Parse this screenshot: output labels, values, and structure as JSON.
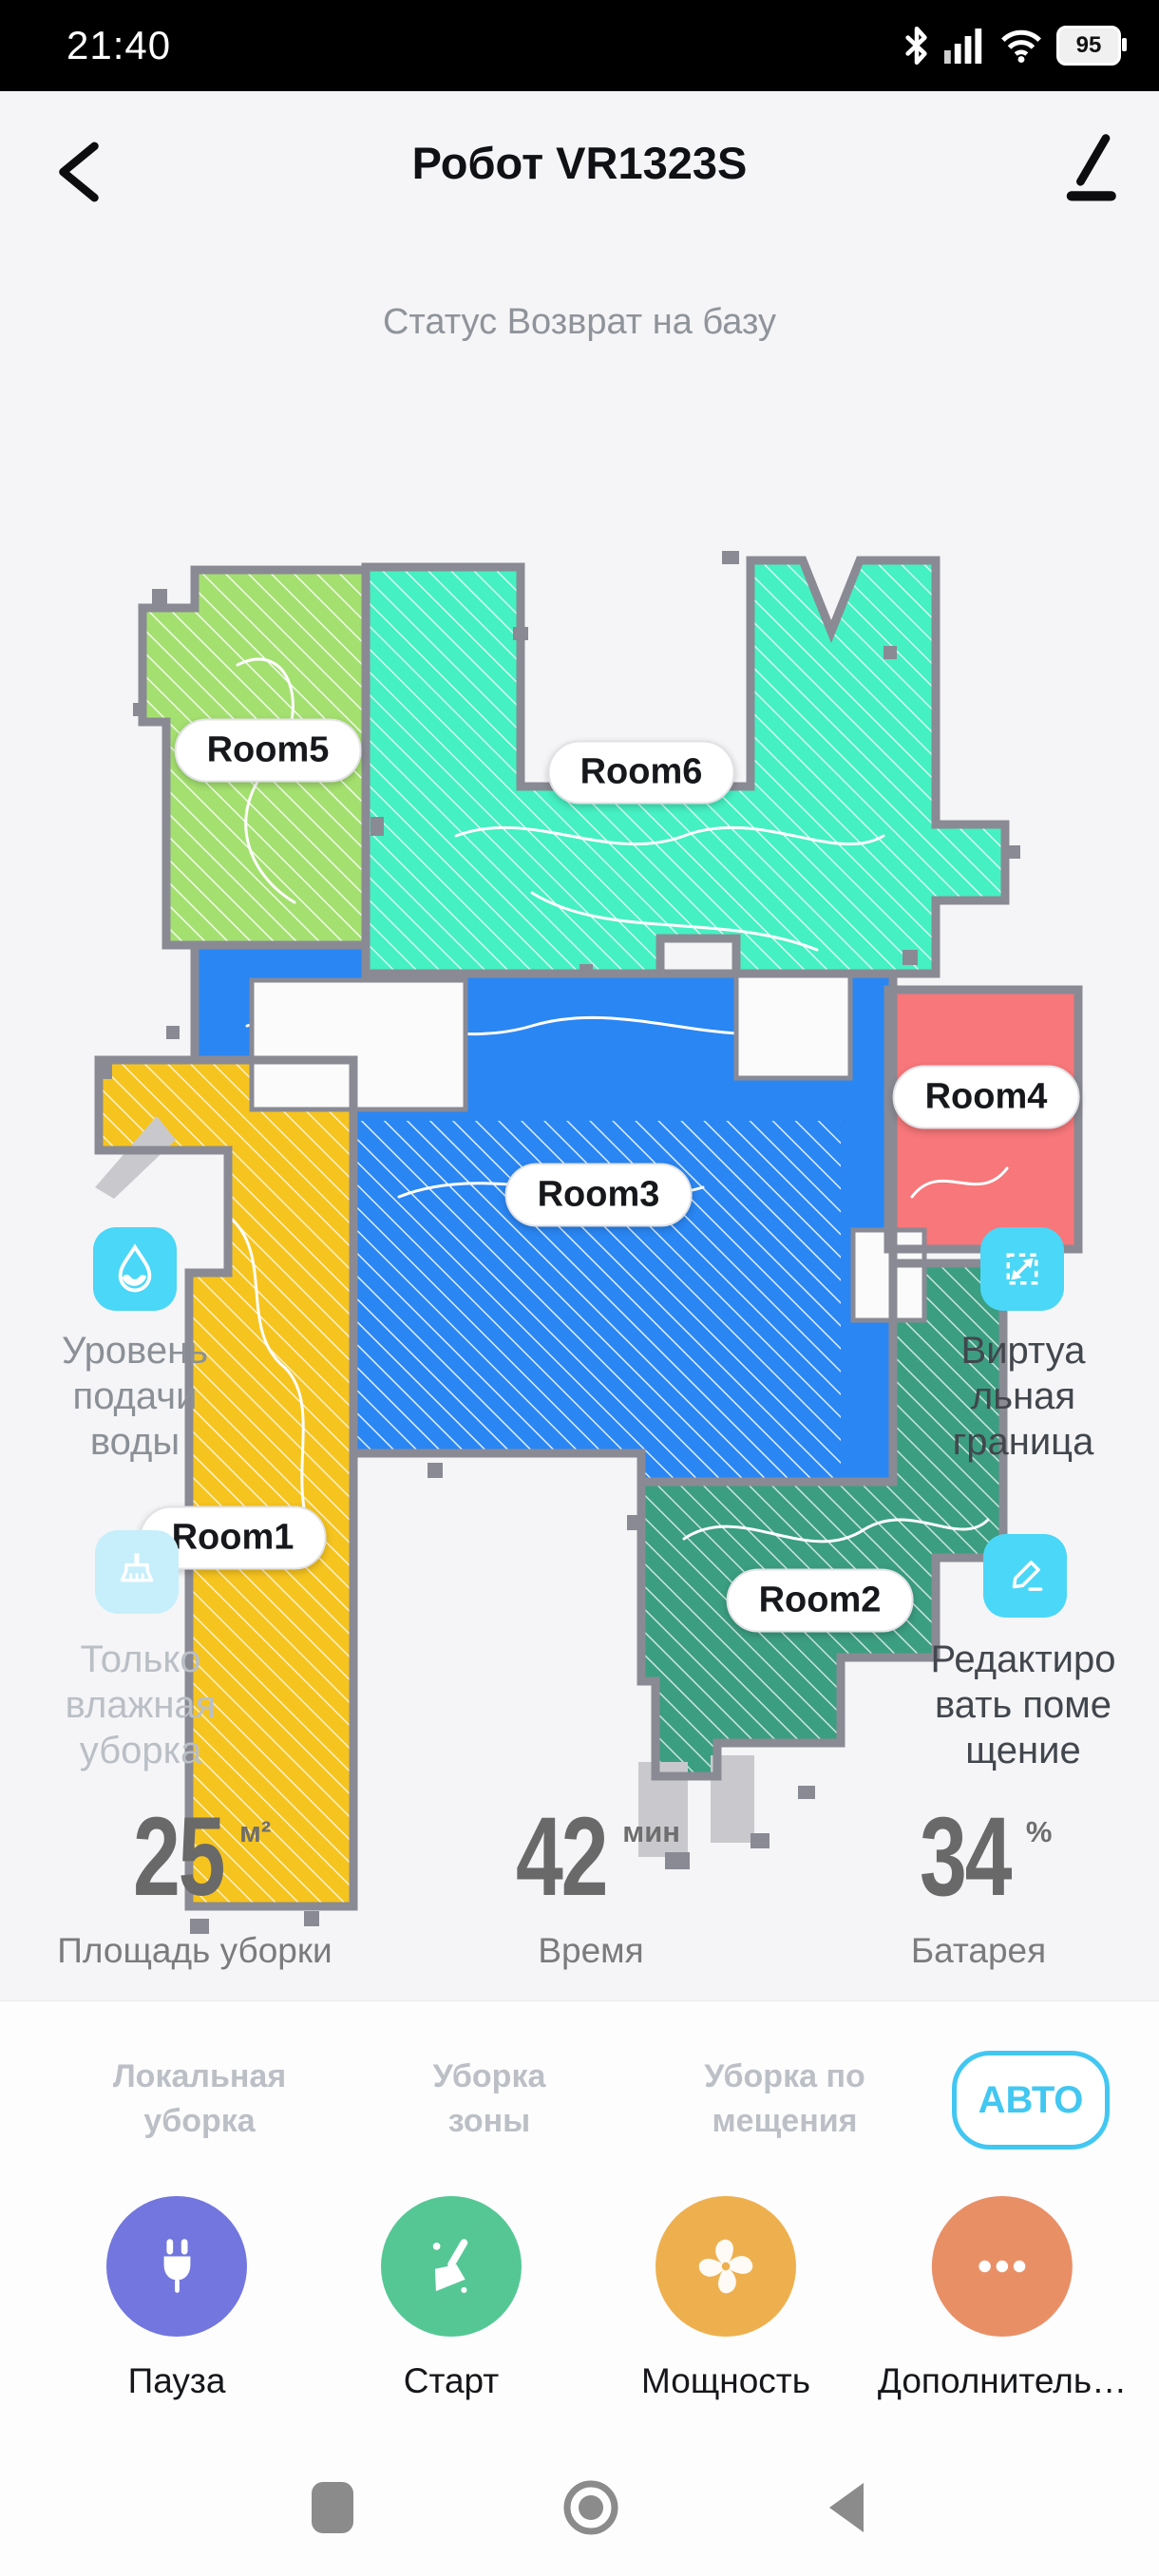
{
  "status_bar": {
    "time": "21:40",
    "battery_percent": "95"
  },
  "header": {
    "title": "Робот VR1323S"
  },
  "status_line": "Статус Возврат на базу",
  "map": {
    "wall_color": "#8a8a94",
    "obstacle_color": "#c9c9cd",
    "rooms": [
      {
        "label": "Room1",
        "color": "#f6c41f"
      },
      {
        "label": "Room2",
        "color": "#3b9e80"
      },
      {
        "label": "Room3",
        "color": "#2a86f3"
      },
      {
        "label": "Room4",
        "color": "#f7777a"
      },
      {
        "label": "Room5",
        "color": "#a4e06f"
      },
      {
        "label": "Room6",
        "color": "#45f0c2"
      }
    ]
  },
  "side_controls": {
    "water_level": {
      "icon": "water-drop-icon",
      "icon_bg": "#4bd7f7",
      "lines": [
        "Уровень",
        "подачи",
        "воды"
      ]
    },
    "wet_clean": {
      "icon": "wet-clean-broom-icon",
      "icon_bg": "#c7effb",
      "lines": [
        "Только",
        "влажная",
        "уборка"
      ]
    },
    "virtual_boundary": {
      "icon": "virtual-boundary-icon",
      "icon_bg": "#4bd7f7",
      "lines": [
        "Виртуа",
        "льная",
        "граница"
      ]
    },
    "edit_room": {
      "icon": "edit-room-icon",
      "icon_bg": "#4bd7f7",
      "lines": [
        "Редактиро",
        "вать поме",
        "щение"
      ]
    }
  },
  "stats": [
    {
      "value": "25",
      "unit": "м²",
      "label": "Площадь уборки"
    },
    {
      "value": "42",
      "unit": "мин",
      "label": "Время"
    },
    {
      "value": "34",
      "unit": "%",
      "label": "Батарея"
    }
  ],
  "modes": {
    "accent": "#41c7f1",
    "active": "АВТО",
    "tabs": [
      {
        "lines": [
          "Локальная",
          "уборка"
        ]
      },
      {
        "lines": [
          "Уборка",
          "зоны"
        ]
      },
      {
        "lines": [
          "Уборка по",
          "мещения"
        ]
      }
    ]
  },
  "actions": [
    {
      "label": "Пауза",
      "color": "#7276de",
      "icon": "plug-icon"
    },
    {
      "label": "Старт",
      "color": "#55c795",
      "icon": "start-broom-icon"
    },
    {
      "label": "Мощность",
      "color": "#eeb04e",
      "icon": "fan-icon"
    },
    {
      "label": "Дополнитель…",
      "color": "#e98f66",
      "icon": "more-dots-icon"
    }
  ]
}
